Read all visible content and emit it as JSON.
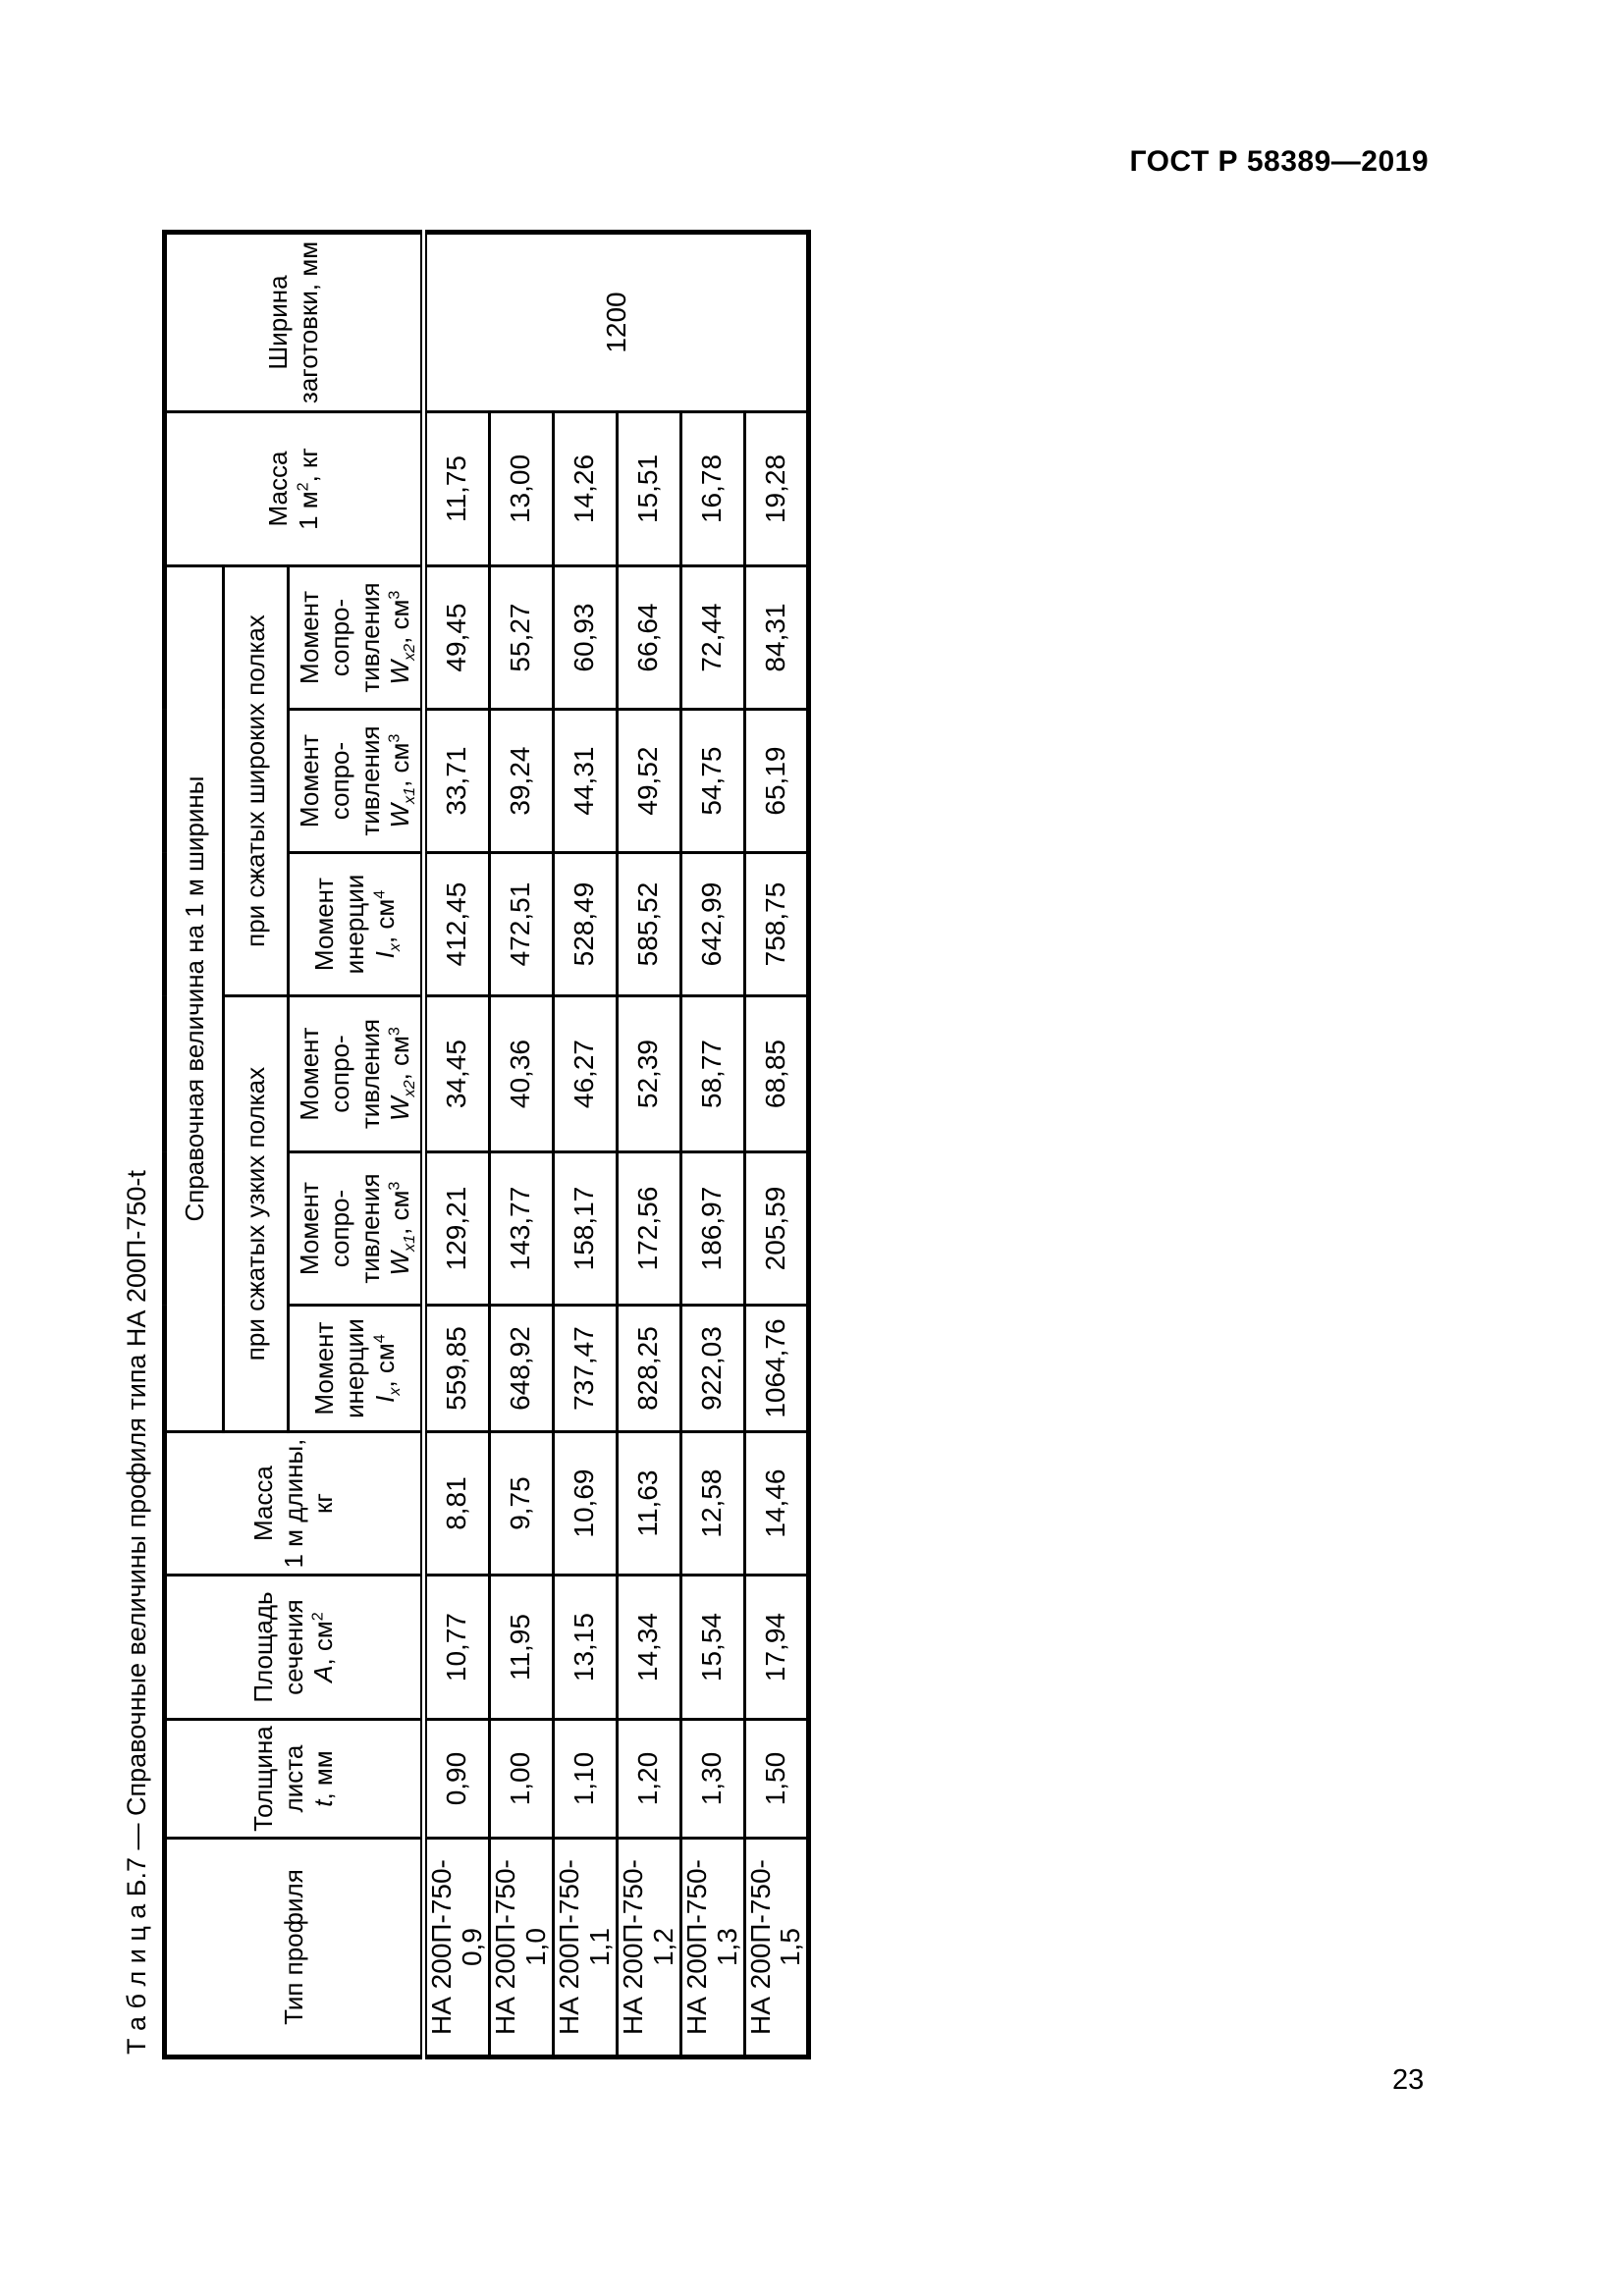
{
  "page": {
    "doc_code": "ГОСТ Р 58389—2019",
    "page_number": "23"
  },
  "table_title": "Т а б л и ц а   Б.7 — Справочные величины профиля типа НА 200П-750-t",
  "table": {
    "headers": {
      "profile_type": "Тип профиля",
      "thickness_pre": "Толщина листа",
      "thickness_sym": "t",
      "thickness_post": ", мм",
      "area_pre": "Площадь сечения",
      "area_sym": "А",
      "area_post": ", см",
      "area_sup": "2",
      "mass_len_line1": "Масса",
      "mass_len_line2": "1 м длины, кг",
      "reference": "Справочная величина на 1 м ширины",
      "narrow": "при сжатых узких полках",
      "wide": "при сжатых широких полках",
      "inertia_pre": "Момент инерции",
      "inertia_sym": "I",
      "inertia_sub": "x",
      "inertia_post": ", см",
      "inertia_sup": "4",
      "res_pre": "Момент сопро- тивления",
      "res_sym": "W",
      "res_sub_x1": "x1",
      "res_sub_x2": "x2",
      "res_post": ", см",
      "res_sup": "3",
      "mass_sq_line1": "Масса",
      "mass_sq_line2_pre": "1 м",
      "mass_sq_sup": "2",
      "mass_sq_post": ", кг",
      "blank_width": "Ширина заготовки, мм"
    },
    "blank_width_value": "1200",
    "rows": [
      {
        "type": "НА 200П-750-0,9",
        "t": "0,90",
        "A": "10,77",
        "m_len": "8,81",
        "ix_n": "559,85",
        "wx1_n": "129,21",
        "wx2_n": "34,45",
        "ix_w": "412,45",
        "wx1_w": "33,71",
        "wx2_w": "49,45",
        "m_sq": "11,75"
      },
      {
        "type": "НА 200П-750-1,0",
        "t": "1,00",
        "A": "11,95",
        "m_len": "9,75",
        "ix_n": "648,92",
        "wx1_n": "143,77",
        "wx2_n": "40,36",
        "ix_w": "472,51",
        "wx1_w": "39,24",
        "wx2_w": "55,27",
        "m_sq": "13,00"
      },
      {
        "type": "НА 200П-750-1,1",
        "t": "1,10",
        "A": "13,15",
        "m_len": "10,69",
        "ix_n": "737,47",
        "wx1_n": "158,17",
        "wx2_n": "46,27",
        "ix_w": "528,49",
        "wx1_w": "44,31",
        "wx2_w": "60,93",
        "m_sq": "14,26"
      },
      {
        "type": "НА 200П-750-1,2",
        "t": "1,20",
        "A": "14,34",
        "m_len": "11,63",
        "ix_n": "828,25",
        "wx1_n": "172,56",
        "wx2_n": "52,39",
        "ix_w": "585,52",
        "wx1_w": "49,52",
        "wx2_w": "66,64",
        "m_sq": "15,51"
      },
      {
        "type": "НА 200П-750-1,3",
        "t": "1,30",
        "A": "15,54",
        "m_len": "12,58",
        "ix_n": "922,03",
        "wx1_n": "186,97",
        "wx2_n": "58,77",
        "ix_w": "642,99",
        "wx1_w": "54,75",
        "wx2_w": "72,44",
        "m_sq": "16,78"
      },
      {
        "type": "НА 200П-750-1,5",
        "t": "1,50",
        "A": "17,94",
        "m_len": "14,46",
        "ix_n": "1064,76",
        "wx1_n": "205,59",
        "wx2_n": "68,85",
        "ix_w": "758,75",
        "wx1_w": "65,19",
        "wx2_w": "84,31",
        "m_sq": "19,28"
      }
    ]
  }
}
